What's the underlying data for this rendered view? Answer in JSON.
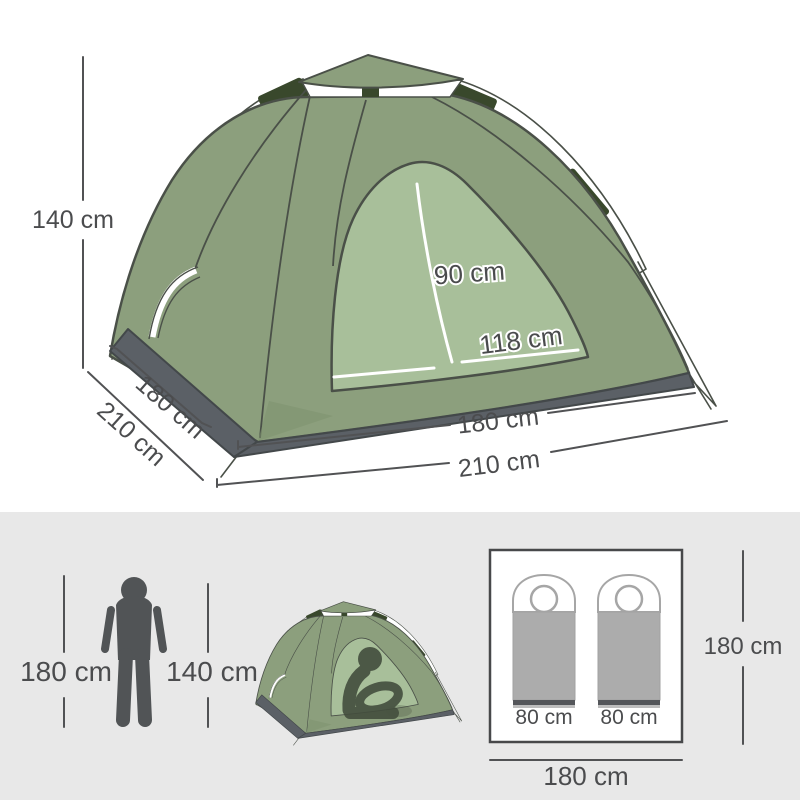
{
  "diagram": {
    "tent_height_label": "140 cm",
    "depth_inner_label": "180 cm",
    "depth_outer_label": "210 cm",
    "door_height_label": "90 cm",
    "door_width_label": "118 cm",
    "front_width_inner_label": "180 cm",
    "front_width_outer_label": "210 cm"
  },
  "scale_row": {
    "person_height_label": "180 cm",
    "small_tent_height_label": "140 cm"
  },
  "floorplan": {
    "bag_left_label": "80 cm",
    "bag_right_label": "80 cm",
    "side_length_label": "180 cm",
    "bottom_length_label": "180 cm"
  },
  "colors": {
    "tent_fabric": "#8C9F7D",
    "tent_door": "#A8BF9A",
    "pole_sleeve": "#39482C",
    "outline": "#4A5048",
    "ground_tarp": "#5B6066",
    "dimension_text": "#4B4C4E",
    "section_background": "#E8E8E8",
    "sleeping_bag": "#ACACAC",
    "icon_gray": "#515456"
  }
}
